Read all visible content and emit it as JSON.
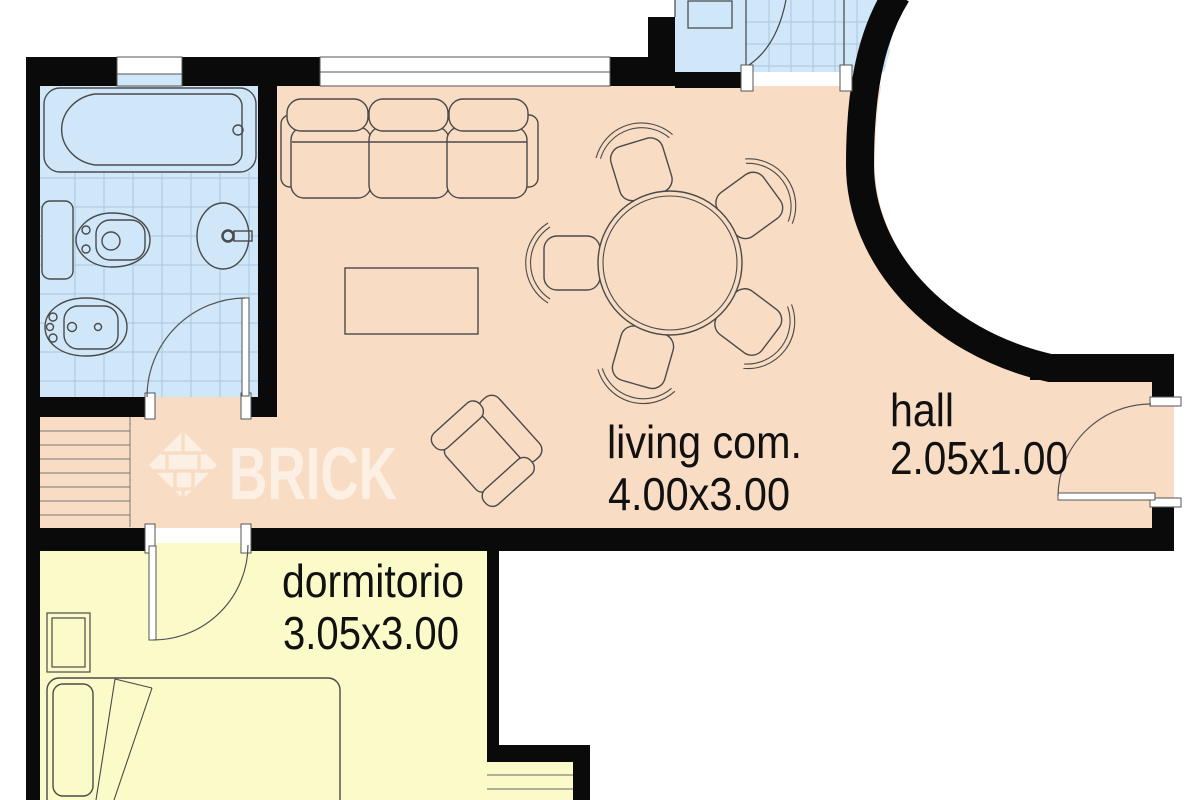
{
  "title": "apartment floor plan",
  "watermark": {
    "brand": "BRICK"
  },
  "rooms": {
    "living": {
      "label": "living com.",
      "dimensions": "4.00x3.00"
    },
    "hall": {
      "label": "hall",
      "dimensions": "2.05x1.00"
    },
    "bedroom": {
      "label": "dormitorio",
      "dimensions": "3.05x3.00"
    }
  },
  "colors": {
    "living_floor": "#f8dcc3",
    "bedroom_floor": "#fafbc9",
    "wet_floor": "#cfe7f8",
    "wall": "#0a0a0a",
    "tile_grid": "#a9c7de",
    "furniture_outline": "#4a4a4a",
    "label_text": "#111111"
  }
}
